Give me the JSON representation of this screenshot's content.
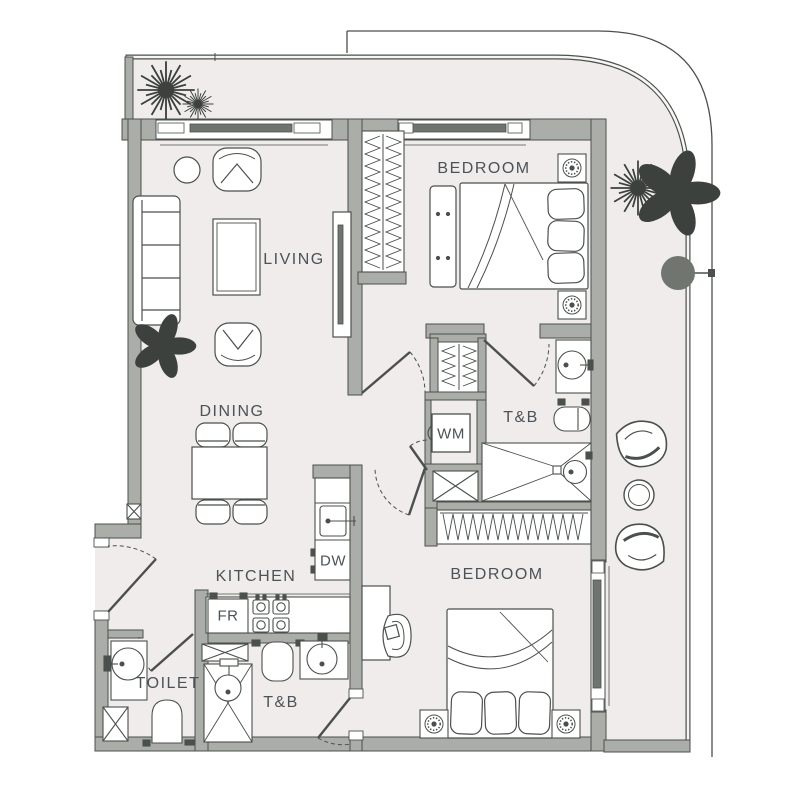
{
  "title": "Apartment unit floor plan",
  "colors": {
    "floor": "#efeceb",
    "wall": "#abaea8",
    "line": "#4b504c",
    "label": "#4c5257",
    "plant": "#3c413d",
    "column": "#70756f"
  },
  "rooms": {
    "living": "LIVING",
    "dining": "DINING",
    "kitchen": "KITCHEN",
    "bedroom_top": "BEDROOM",
    "bedroom_bottom": "BEDROOM",
    "bath_top": "T&B",
    "bath_bottom": "T&B",
    "toilet": "TOILET"
  },
  "appliances": {
    "washing_machine": "WM",
    "dishwasher": "DW",
    "fridge": "FR"
  }
}
